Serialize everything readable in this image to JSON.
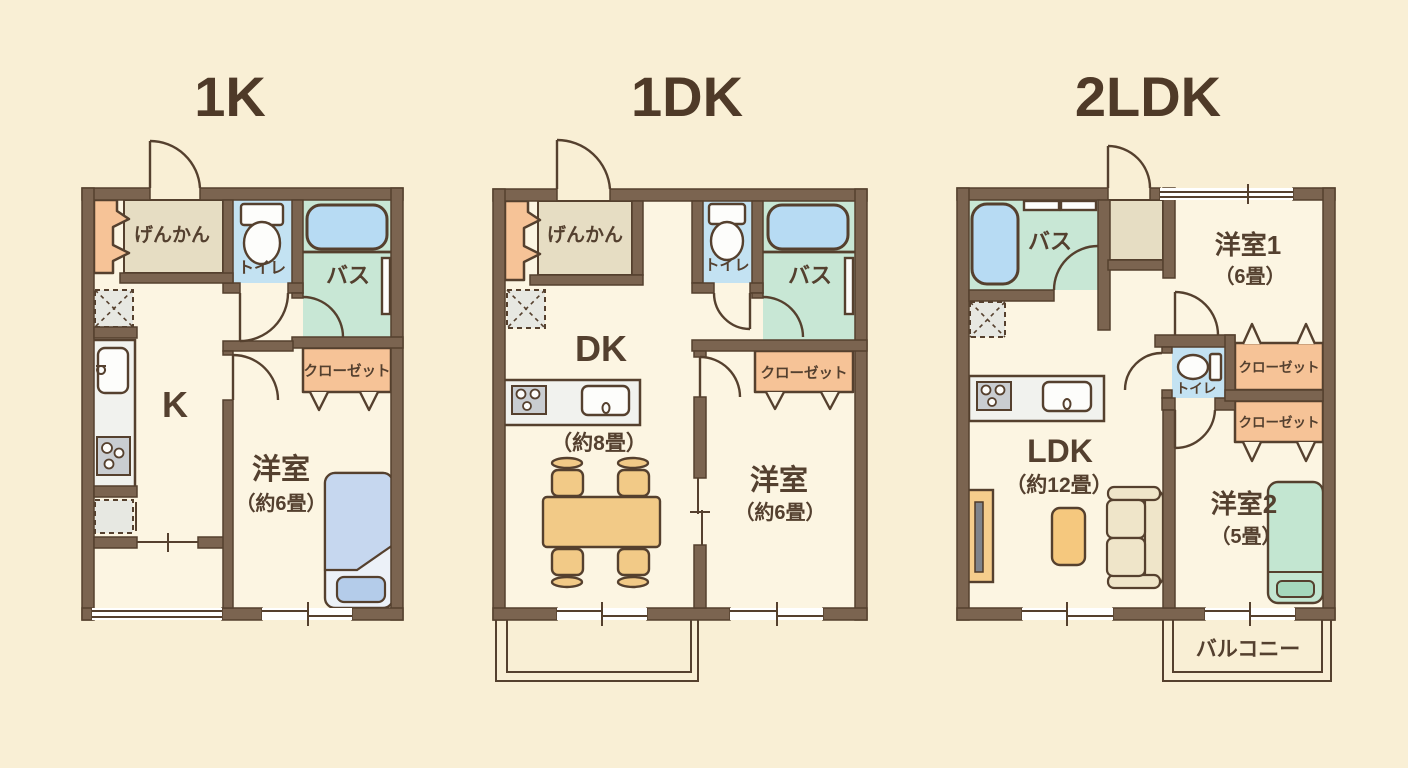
{
  "page": {
    "background": "#F9EFD5",
    "description": "Japanese apartment floor plan comparison: 1K / 1DK / 2LDK"
  },
  "colors": {
    "background": "#F9EFD5",
    "floor": "#FCF5E2",
    "wall": "#7B6450",
    "wall_outline": "#55402E",
    "text": "#54402F",
    "entrance_floor": "#E6DDC3",
    "closet_orange": "#F6C397",
    "toilet_floor_blue": "#C3E2F2",
    "bath_floor_green": "#C8E7D5",
    "bathtub_blue": "#B7DBF3",
    "counter_gray": "#F1F2EE",
    "stove_gray": "#C9CDD1",
    "wood_orange": "#F2CA87",
    "sofa_cream": "#EFE5C9",
    "bed_blue": "#C6D7EF",
    "bed_green": "#C3E6D1"
  },
  "plans": [
    {
      "id": "1K",
      "title": "1K",
      "labels": {
        "entrance": "げんかん",
        "toilet": "トイレ",
        "bath": "バス",
        "closet": "クローゼット",
        "kitchen": "K",
        "bedroom": "洋室",
        "bedroom_size": "（約6畳）"
      }
    },
    {
      "id": "1DK",
      "title": "1DK",
      "labels": {
        "entrance": "げんかん",
        "toilet": "トイレ",
        "bath": "バス",
        "closet": "クローゼット",
        "dining_kitchen": "DK",
        "dining_kitchen_size": "（約8畳）",
        "bedroom": "洋室",
        "bedroom_size": "（約6畳）"
      }
    },
    {
      "id": "2LDK",
      "title": "2LDK",
      "labels": {
        "bath": "バス",
        "toilet": "トイレ",
        "closet1": "クローゼット",
        "closet2": "クローゼット",
        "living": "LDK",
        "living_size": "（約12畳）",
        "bedroom1": "洋室1",
        "bedroom1_size": "（6畳）",
        "bedroom2": "洋室2",
        "bedroom2_size": "（5畳）",
        "balcony": "バルコニー"
      }
    }
  ]
}
